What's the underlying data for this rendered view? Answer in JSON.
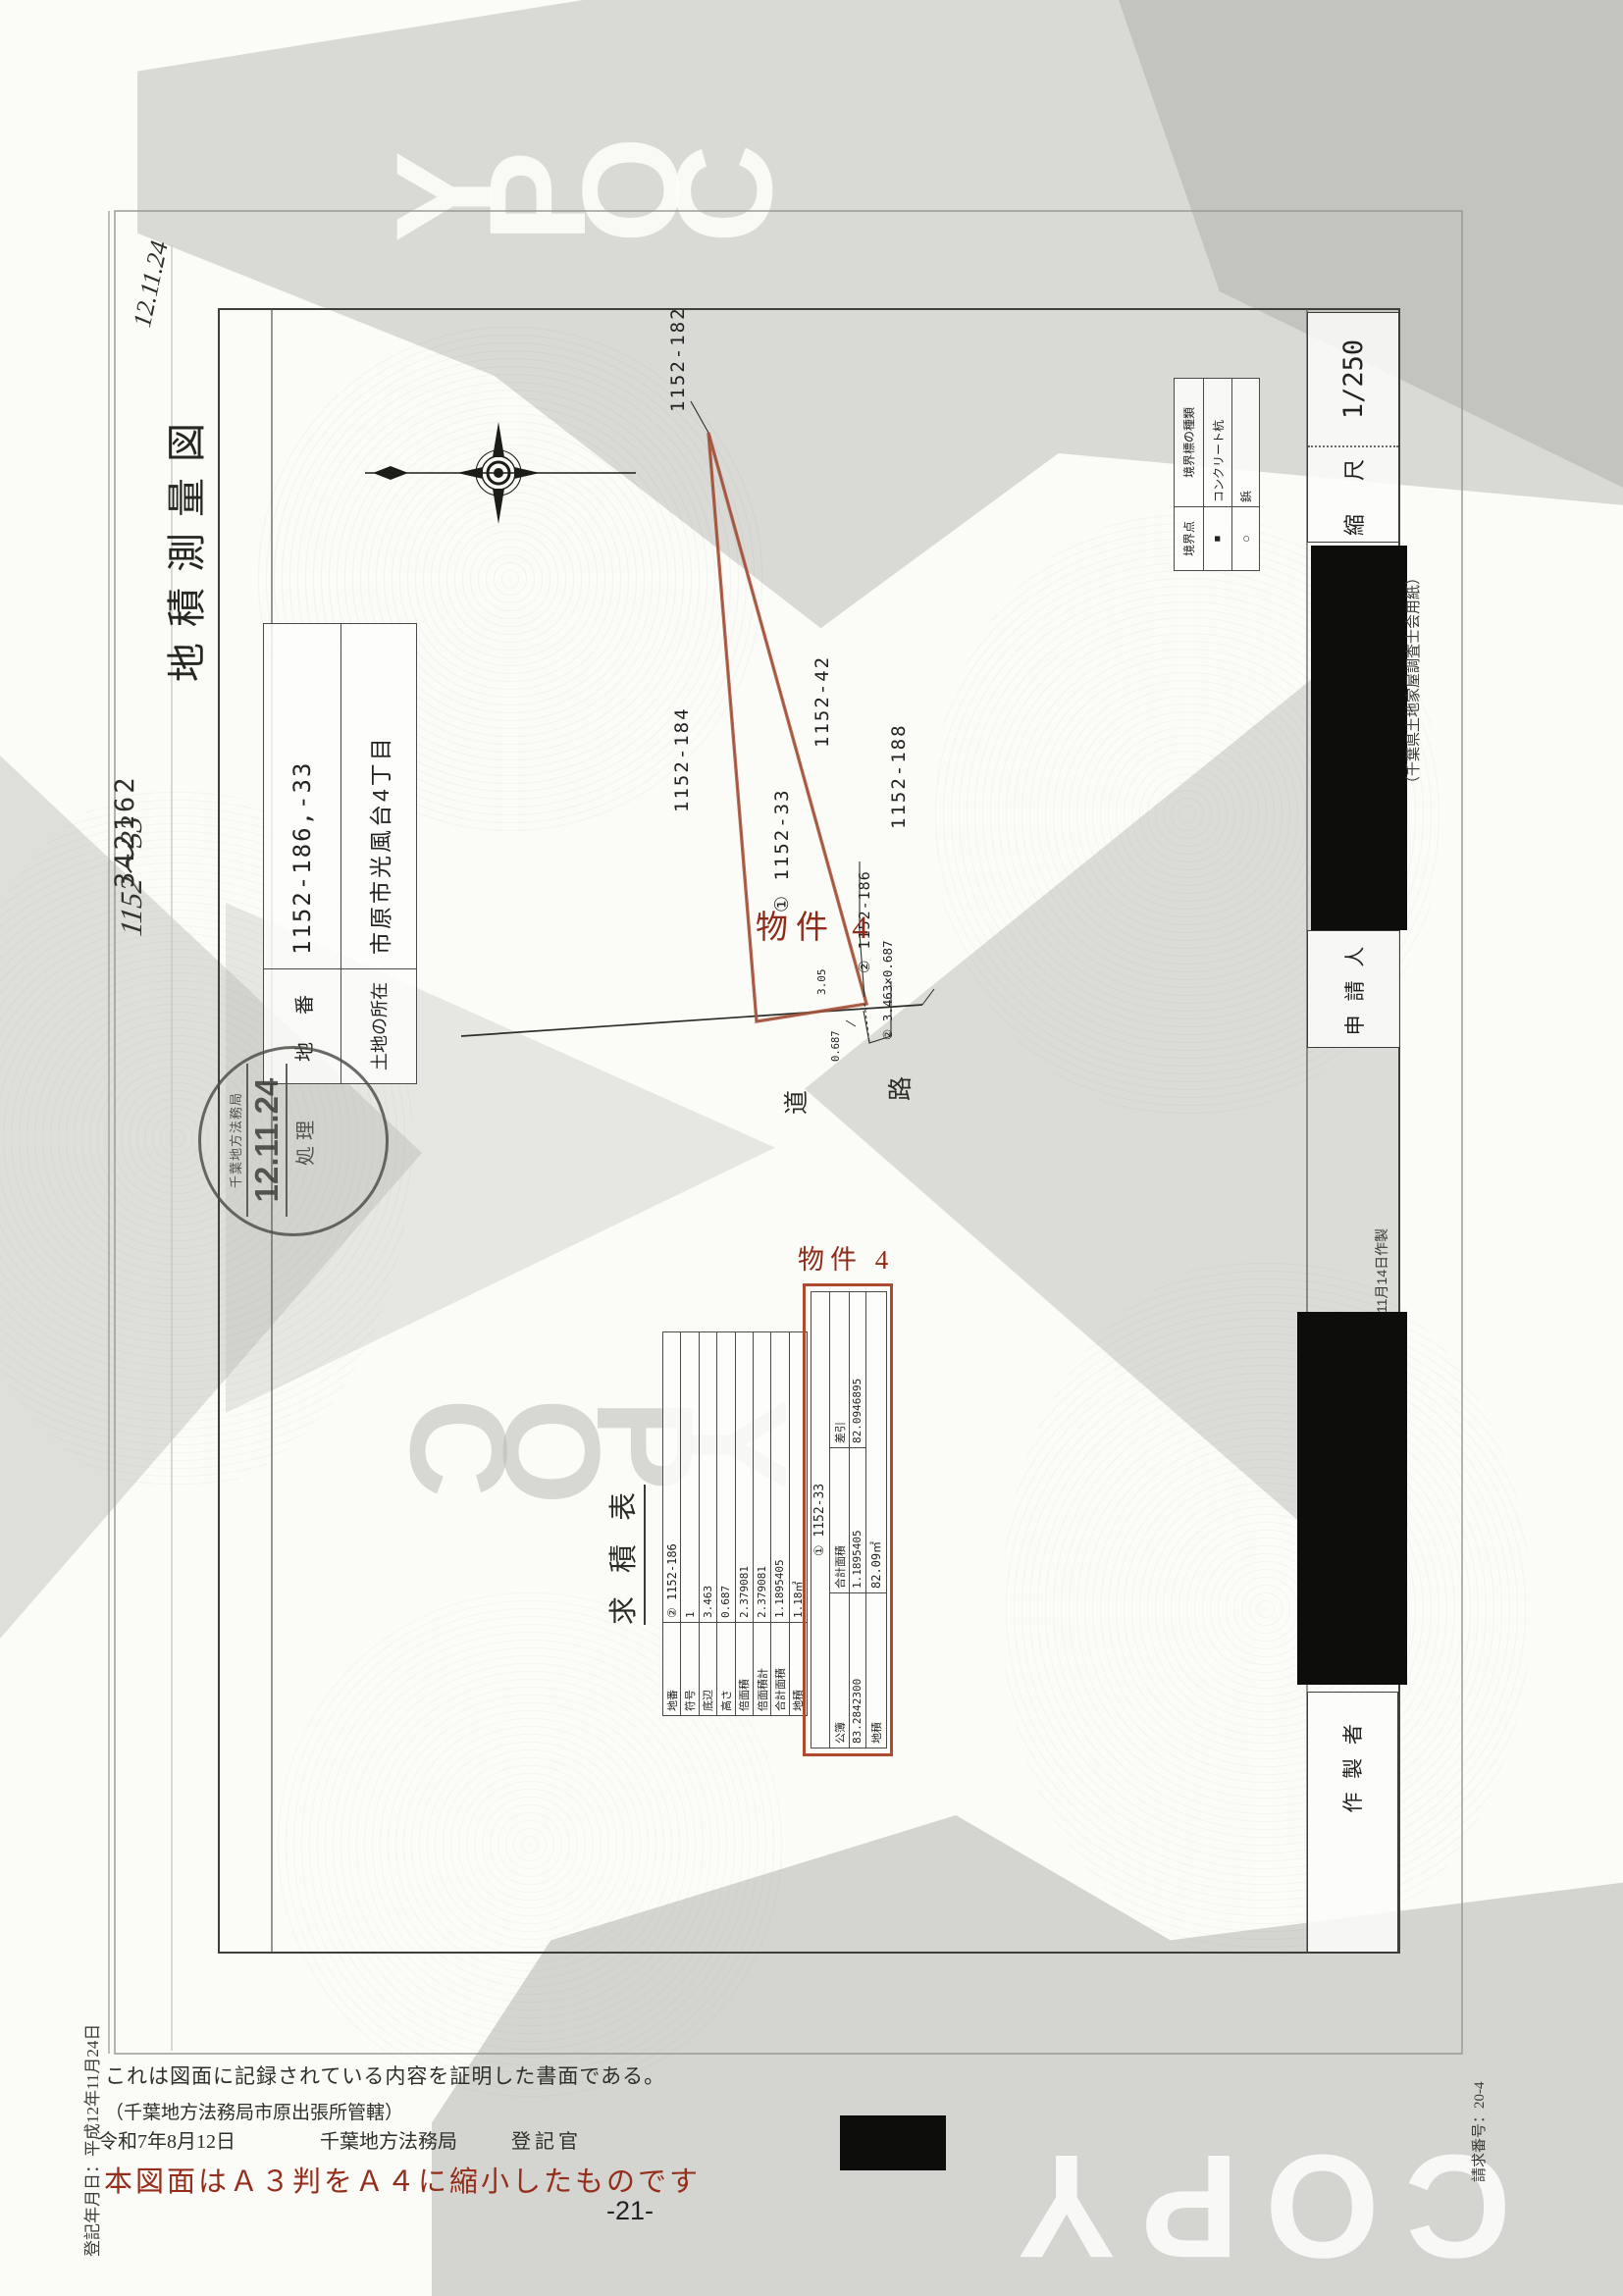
{
  "watermark": {
    "text": "COPY"
  },
  "handwriting": {
    "top_note": "12.11.24",
    "side_note": "1152〜33"
  },
  "doc_number": "342162",
  "title_block": {
    "title": "地積測量図",
    "lot_label": "地　番",
    "lot_value": "1152-186,-33",
    "location_label": "土地の所在",
    "location_value": "市原市光風台4丁目"
  },
  "receipt_stamp": {
    "office": "千葉地方法務局",
    "date": "12.11.24",
    "word": "処理"
  },
  "plot": {
    "parcels": {
      "p182": "1152-182",
      "p184": "1152-184",
      "p33": "① 1152-33",
      "p42": "1152-42",
      "p188": "1152-188",
      "p186": "② 1152-186"
    },
    "strip_note": "② 3.463×0.687",
    "dim_a": "3.05",
    "dim_b": "0.687",
    "road_char1": "道",
    "road_char2": "路",
    "property_tag": "物件 4"
  },
  "scale_box": {
    "label": "縮　尺",
    "value": "1/250"
  },
  "legend": {
    "point_header": "境界点",
    "kind_header": "境界標の種類",
    "rows": [
      [
        "■",
        "コンクリート杭"
      ],
      [
        "○",
        "鋲"
      ],
      [
        "",
        ""
      ]
    ]
  },
  "right_column": {
    "applicant": "申 請 人",
    "preparer": "作 製 者",
    "made_date": "11月14日作製",
    "paper_note": "（千葉県土地家屋調査士会用紙）"
  },
  "survey_table": {
    "caption": "求 積 表",
    "left": {
      "rows": [
        [
          "地番",
          "② 1152-186"
        ],
        [
          "符号",
          "1"
        ],
        [
          "底辺",
          "3.463"
        ],
        [
          "高さ",
          "0.687"
        ],
        [
          "倍面積",
          "2.379081"
        ],
        [
          "倍面積計",
          "2.379081"
        ],
        [
          "合計面積",
          "1.1895405"
        ],
        [
          "地積",
          "1.18㎡"
        ]
      ]
    },
    "right": {
      "property_tag": "物件 4",
      "header": "① 1152-33",
      "labels": [
        "公簿",
        "合計面積",
        "差引"
      ],
      "values": [
        "83.2842300",
        "1.1895405",
        "82.0946895"
      ],
      "area_label": "地積",
      "area_value": "82.09㎡"
    }
  },
  "footer": {
    "registered_date": "登記年月日：平成12年11月24日",
    "cert_line": "これは図面に記録されている内容を証明した書面である。",
    "jurisdiction": "（千葉地方法務局市原出張所管轄）",
    "issue_date": "令和7年8月12日",
    "issue_office": "千葉地方法務局",
    "officer": "登記官",
    "reduction_note": "本図面はＡ３判をＡ４に縮小したものです",
    "page_number": "-21-",
    "request_number": "請求番号：20-4"
  }
}
